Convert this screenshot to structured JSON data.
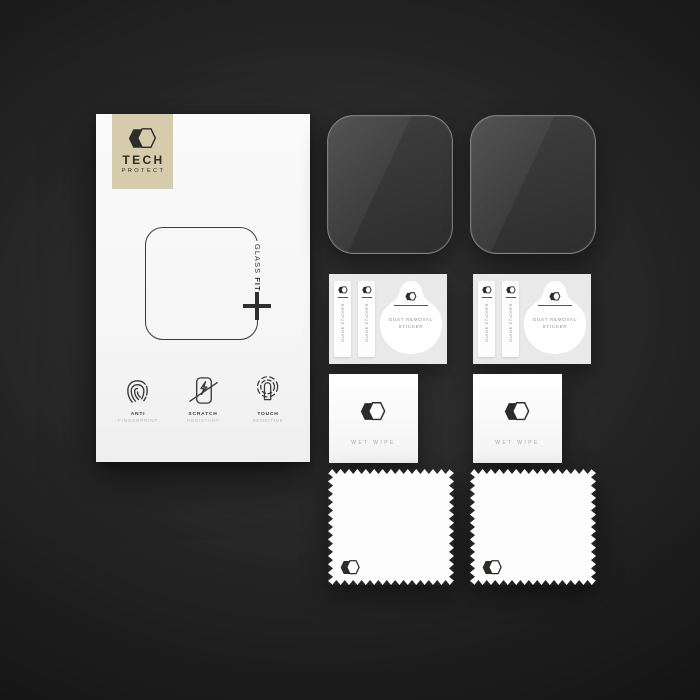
{
  "product": {
    "brand": {
      "name": "TECH",
      "subname": "PROTECT"
    },
    "box": {
      "glass_fit": {
        "word1": "GLASS",
        "word2": "FIT"
      },
      "features": [
        {
          "icon": "fingerprint-icon",
          "line1": "ANTI",
          "line2": "FINGERPRINT"
        },
        {
          "icon": "scratch-resistant-icon",
          "line1": "SCRATCH",
          "line2": "RESISTANT"
        },
        {
          "icon": "touch-sensitive-icon",
          "line1": "TOUCH",
          "line2": "SENSITIVE"
        }
      ]
    },
    "accessories": {
      "guide_sticker": "GUIDE STICKER",
      "dust_removal_line1": "DUST REMOVAL",
      "dust_removal_line2": "STICKER",
      "wet_wipe": "WET WIPE",
      "counts": {
        "glass_protectors": 2,
        "sticker_cards": 2,
        "wet_wipes": 2,
        "cloths": 2
      }
    },
    "icons": {
      "brand_logo": "double-hexagon-icon",
      "glass_fit_plus": "plus-icon",
      "feature_icons": [
        "fingerprint-icon",
        "scratch-resistant-icon",
        "touch-sensitive-icon"
      ],
      "accessory_logo": "double-hexagon-icon"
    }
  },
  "colors": {
    "background_center": "#323232",
    "background_edge": "#151515",
    "box_white": "#f8f8f8",
    "badge_beige": "#d6ccab",
    "ink_dark": "#2c2c28",
    "ink_light": "#bdbdbd",
    "card_gray": "#e9e9e9",
    "glass_fill": "#363636",
    "glass_edge": "#c8c8c8"
  }
}
